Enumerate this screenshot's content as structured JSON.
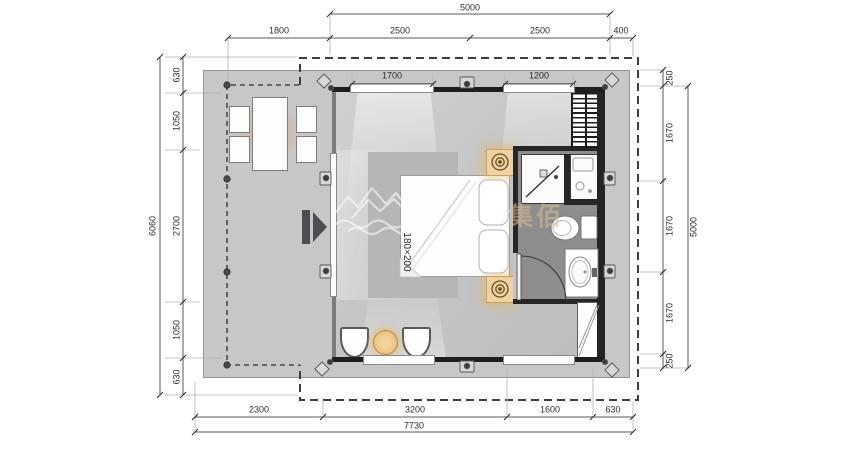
{
  "drawing": {
    "type_label": "floor-plan",
    "bed": {
      "size_label": "180×200"
    },
    "watermark": {
      "text": "集佰"
    }
  },
  "dimensions": {
    "top": {
      "overall": "5000",
      "segments": [
        "1800",
        "2500",
        "2500",
        "400"
      ],
      "windows": [
        "1700",
        "1200"
      ]
    },
    "left": {
      "overall": "6060",
      "segments": [
        "630",
        "1050",
        "2700",
        "1050",
        "630"
      ]
    },
    "right": {
      "overall": "5000",
      "segments": [
        "250",
        "1670",
        "1670",
        "1670",
        "250"
      ]
    },
    "bottom": {
      "overall": "7730",
      "segments": [
        "2300",
        "3200",
        "1600",
        "630"
      ]
    }
  },
  "colors": {
    "deck": "#c7c7c7",
    "room_floor": "#c6c6c6",
    "rug": "#b6b6b6",
    "wall_dark": "#262626",
    "bathroom_floor": "#8d8d8d",
    "accent_glow": "#e8b269",
    "nightstand": "#eed2a2"
  }
}
